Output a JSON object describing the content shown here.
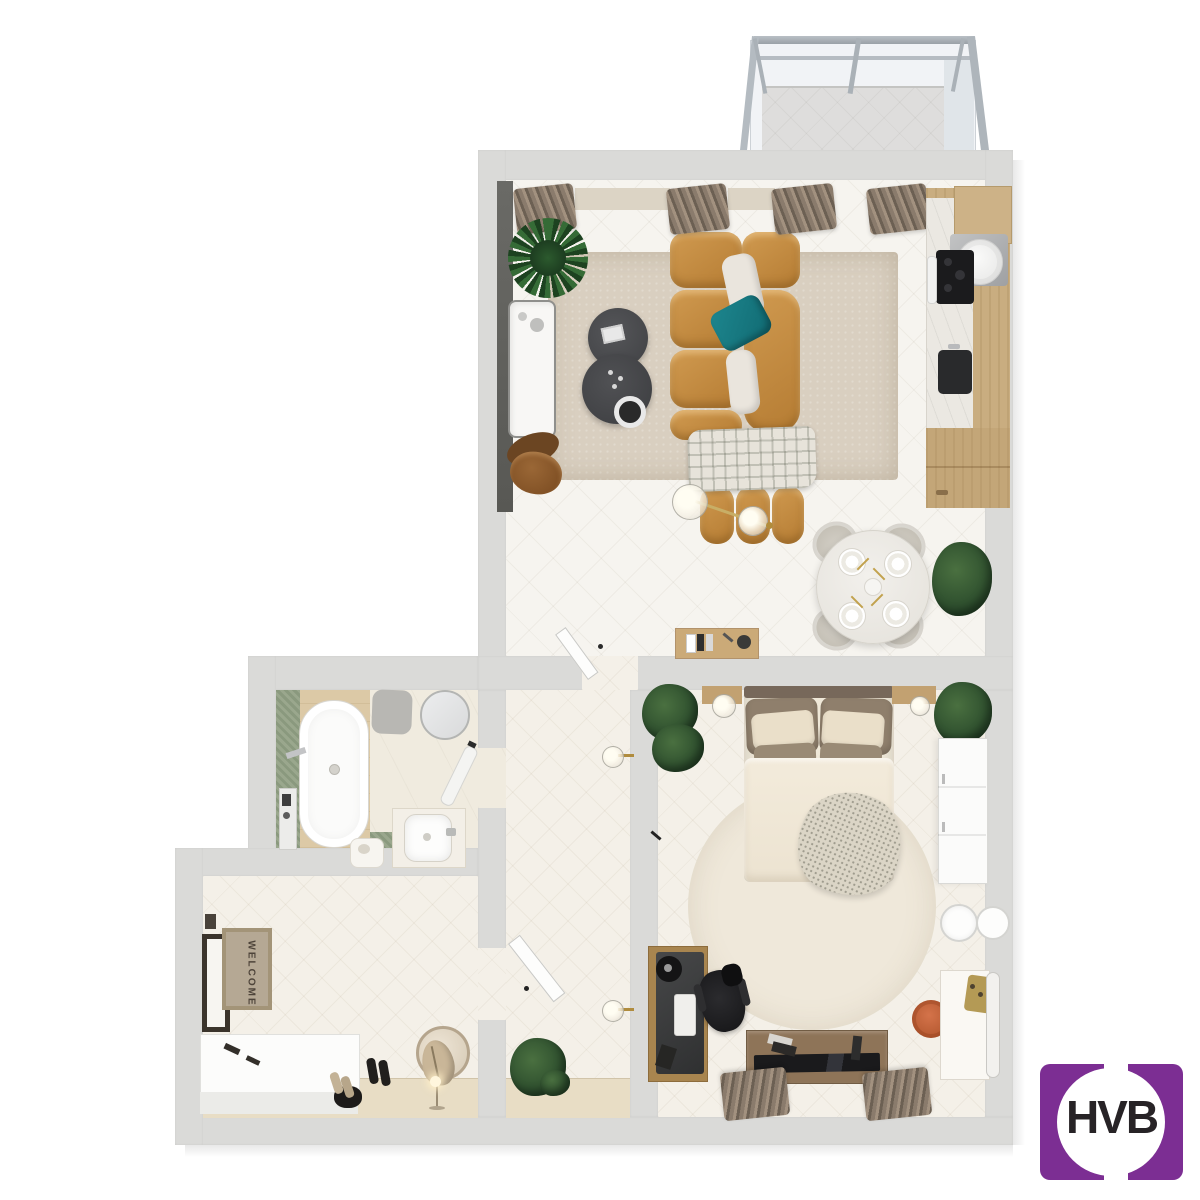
{
  "scene": {
    "type": "3d-top-down-floor-plan-render",
    "rooms": [
      {
        "name": "living-room-kitchen",
        "furniture": [
          "corner-sofa-mustard",
          "teal-pillow",
          "plaid-blanket",
          "round-coffee-tables",
          "area-rug",
          "marble-sideboard",
          "leather-lounge-chair",
          "potted-plant",
          "pendant-light",
          "wall-console-with-books",
          "kitchen-counter",
          "cooktop",
          "extractor-hood",
          "sink",
          "round-dining-table-4-chairs",
          "dining-plant",
          "window-curtains"
        ]
      },
      {
        "name": "balcony",
        "furniture": [
          "glazed-frame",
          "parapet-panel"
        ]
      },
      {
        "name": "bathroom",
        "furniture": [
          "freestanding-bathtub",
          "green-tile-wall",
          "round-mirror",
          "vanity-sink",
          "bath-mat",
          "shower-column",
          "towel-rail",
          "stool"
        ]
      },
      {
        "name": "bedroom",
        "furniture": [
          "double-bed",
          "throw-blanket",
          "round-rug",
          "hanging-plants",
          "wall-shelf-nightstands",
          "pendant-globe-lamps",
          "wardrobe",
          "wall-sconces",
          "desk-with-chair",
          "tv-console",
          "vanity-with-mirror",
          "orange-pouf",
          "window-curtains"
        ]
      },
      {
        "name": "corridor",
        "furniture": [
          "wall-lamps",
          "open-door",
          "potted-plant"
        ]
      },
      {
        "name": "entrance-hall",
        "furniture": [
          "entry-door",
          "welcome-mat",
          "storage-bench",
          "shoes",
          "leaning-round-mirror",
          "bag",
          "floor-lamp"
        ]
      }
    ]
  },
  "entrance": {
    "door_mat_text": "WELCOME"
  },
  "branding": {
    "logo_text": "HVB",
    "logo_bg_color": "#7c2e93",
    "logo_text_color": "#272326"
  },
  "palette": {
    "wall_gray": "#dadad8",
    "floor_light": "#f6f4ef",
    "floor_cream": "#f4f0e8",
    "rug_beige": "#d9cfc0",
    "sofa_mustard": "#c08440",
    "pillow_teal": "#177c85",
    "coffee_table_gray": "#4a4b4d",
    "kitchen_wood": "#c9ad80",
    "bathroom_green_tile": "#9aa78d",
    "pouf_orange": "#c8663a",
    "curtain_brown": "#8a7b6c"
  }
}
